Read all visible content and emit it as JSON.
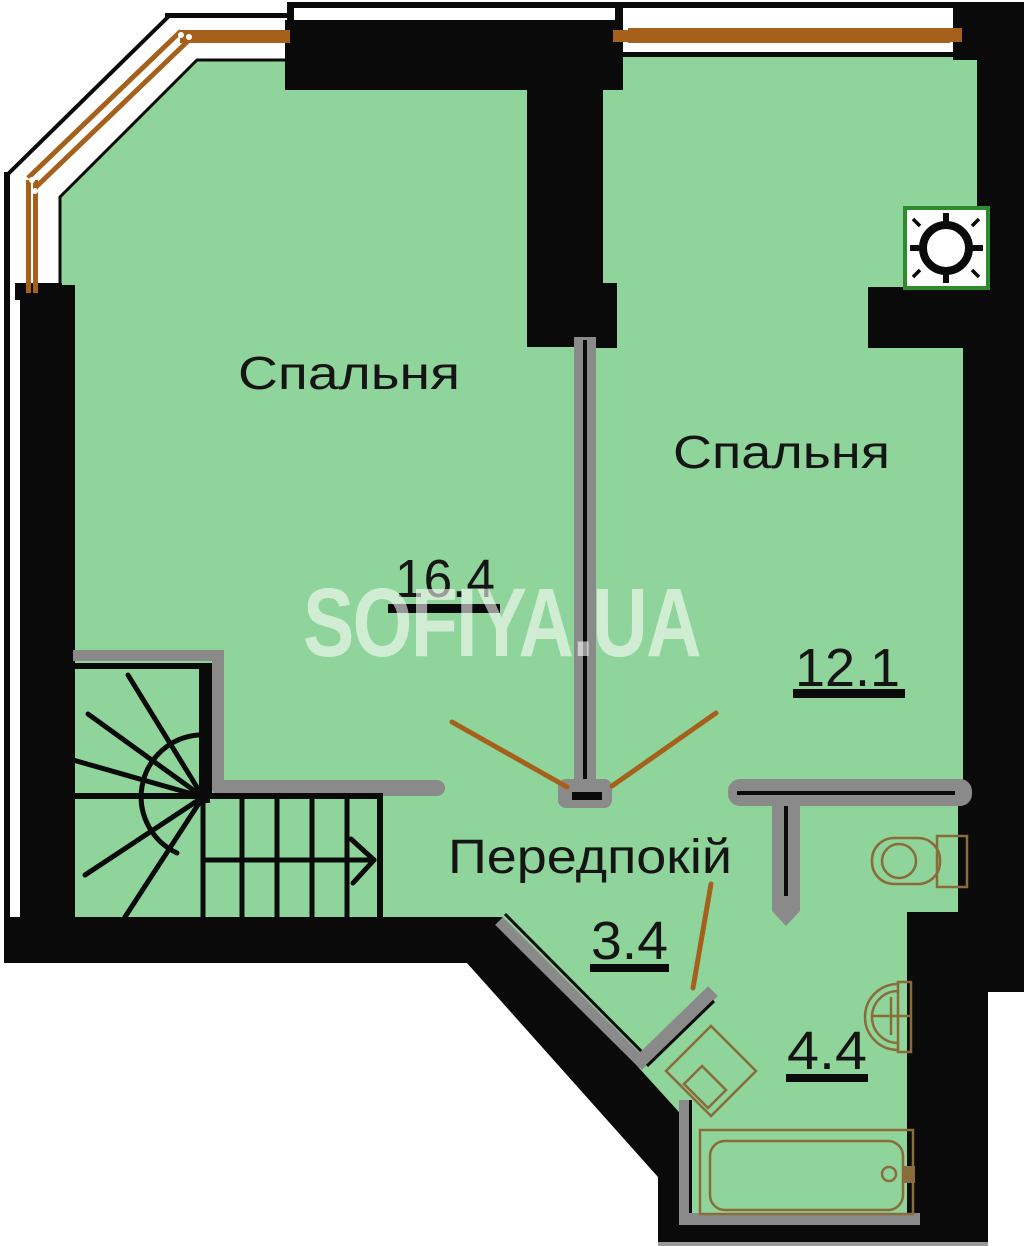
{
  "plan": {
    "watermark": {
      "text": "SOFIYA.UA"
    },
    "rooms": [
      {
        "id": "bedroom-1",
        "label": "Спальня",
        "area": "16.4"
      },
      {
        "id": "bedroom-2",
        "label": "Спальня",
        "area": "12.1"
      },
      {
        "id": "hallway",
        "label": "Передпокій",
        "area": "3.4"
      },
      {
        "id": "bathroom",
        "area": "4.4"
      }
    ],
    "features": [
      "staircase-winder",
      "ventilation-shaft",
      "toilet",
      "sink",
      "bathtub",
      "washing-machine",
      "balcony-glazing-windows"
    ]
  },
  "colors": {
    "floor": "#8FD49A",
    "wall": "#0A0A0A",
    "partition": "#8A8A8A",
    "sliver": "#9A9A9A",
    "window-brown": "#A5611C",
    "fixture-brown": "#8A6B3A",
    "vent-green": "#2E8B2E",
    "label": "#151515",
    "watermark": "rgba(255,255,255,0.58)"
  }
}
